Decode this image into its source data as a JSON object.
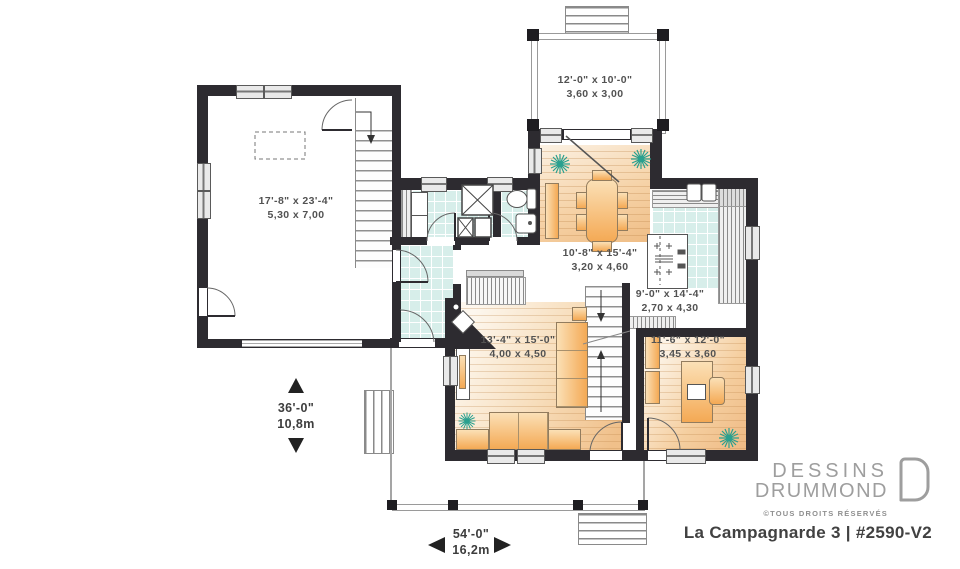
{
  "meta": {
    "plan_title": "La Campagnarde 3 | #2590-V2"
  },
  "branding": {
    "name_line1": "DESSINS",
    "name_line2": "DRUMMOND",
    "rights": "©TOUS DROITS RÉSERVÉS"
  },
  "rooms": {
    "deck": {
      "imperial": "12'-0\" x 10'-0\"",
      "metric": "3,60 x 3,00"
    },
    "garage": {
      "imperial": "17'-8\" x 23'-4\"",
      "metric": "5,30 x 7,00"
    },
    "dining": {
      "imperial": "10'-8\" x 15'-4\"",
      "metric": "3,20 x 4,60"
    },
    "kitchen": {
      "imperial": "9'-0\" x 14'-4\"",
      "metric": "2,70 x 4,30"
    },
    "living": {
      "imperial": "13'-4\" x 15'-0\"",
      "metric": "4,00 x 4,50"
    },
    "office": {
      "imperial": "11'-6\" x 12'-0\"",
      "metric": "3,45 x 3,60"
    }
  },
  "overall_dimensions": {
    "depth": {
      "imperial": "36'-0\"",
      "metric": "10,8m"
    },
    "width": {
      "imperial": "54'-0\"",
      "metric": "16,2m"
    }
  },
  "colors": {
    "wall": "#2d2b30",
    "tile": "#d7eeea",
    "wood_light": "#fcf3e6",
    "wood_dark": "#efba84",
    "furniture": "#f4a954",
    "plant": "#2aa08f"
  }
}
